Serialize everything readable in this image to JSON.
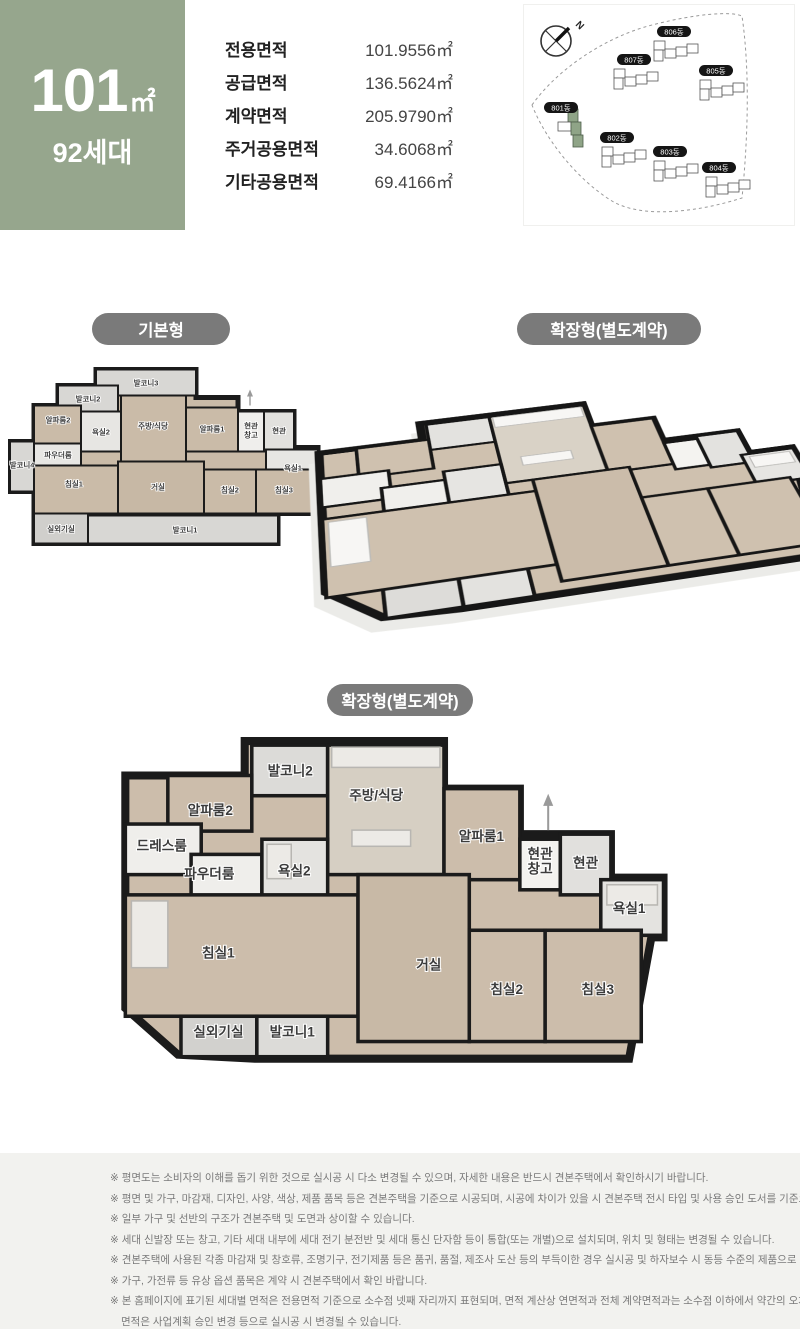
{
  "unit_summary": {
    "size_number": "101",
    "size_unit": "㎡",
    "households": "92세대"
  },
  "area_table": {
    "rows": [
      {
        "label": "전용면적",
        "value": "101.9556㎡"
      },
      {
        "label": "공급면적",
        "value": "136.5624㎡"
      },
      {
        "label": "계약면적",
        "value": "205.9790㎡"
      },
      {
        "label": "주거공용면적",
        "value": "34.6068㎡"
      },
      {
        "label": "기타공용면적",
        "value": "69.4166㎡"
      }
    ]
  },
  "site_map": {
    "north_label": "N",
    "buildings": [
      {
        "name": "801동",
        "highlighted": true
      },
      {
        "name": "802동",
        "highlighted": false
      },
      {
        "name": "803동",
        "highlighted": false
      },
      {
        "name": "804동",
        "highlighted": false
      },
      {
        "name": "805동",
        "highlighted": false
      },
      {
        "name": "806동",
        "highlighted": false
      },
      {
        "name": "807동",
        "highlighted": false
      }
    ],
    "highlight_color": "#8fa487"
  },
  "sections": {
    "basic_pill": "기본형",
    "extended_pill_top": "확장형(별도계약)",
    "extended_pill_bottom": "확장형(별도계약)"
  },
  "rooms": {
    "balcony1": "발코니1",
    "balcony2": "발코니2",
    "balcony3": "발코니3",
    "balcony4": "발코니4",
    "alpha1": "알파룸1",
    "alpha2": "알파룸2",
    "bath1": "욕실1",
    "bath2": "욕실2",
    "kitchen": "주방/식당",
    "entry": "현관",
    "entry_storage_l1": "현관",
    "entry_storage_l2": "창고",
    "powder": "파우더룸",
    "dress": "드레스룸",
    "bed1": "침실1",
    "bed2": "침실2",
    "bed3": "침실3",
    "living": "거실",
    "ac": "실외기실"
  },
  "disclaimer": {
    "lines": [
      "※ 평면도는 소비자의 이해를 돕기 위한 것으로 실시공 시 다소 변경될 수 있으며, 자세한 내용은 반드시 견본주택에서 확인하시기 바랍니다.",
      "※ 평면 및 가구, 마감재, 디자인, 사양, 색상, 제품 품목 등은 견본주택을 기준으로 시공되며, 시공에 차이가 있을 시 견본주택 전시 타입 및 사용 승인 도서를 기준으로 합니다.",
      "※ 일부 가구 및 선반의 구조가 견본주택 및 도면과 상이할 수 있습니다.",
      "※ 세대 신발장 또는 창고, 기타 세대 내부에 세대 전기 분전반 및 세대 통신 단자함 등이 통합(또는 개별)으로 설치되며, 위치 및 형태는 변경될 수 있습니다.",
      "※ 견본주택에 사용된 각종 마감재 및 창호류, 조명기구, 전기제품 등은 품귀, 품절, 제조사 도산 등의 부득이한 경우 실시공 및 하자보수 시 동등 수준의 제품으로 변경될 수 있습니다.",
      "※ 가구, 가전류 등 유상 옵션 품목은 계약 시 견본주택에서 확인 바랍니다.",
      "※ 본 홈페이지에 표기된 세대별 면적은 전용면적 기준으로 소수점 넷째 자리까지 표현되며, 면적 계산상 연면적과 전체 계약면적과는 소수점 이하에서 약간의 오차가 생길 수 있으며,",
      "면적은 사업계획 승인 변경 등으로 실시공 시 변경될 수 있습니다."
    ]
  }
}
